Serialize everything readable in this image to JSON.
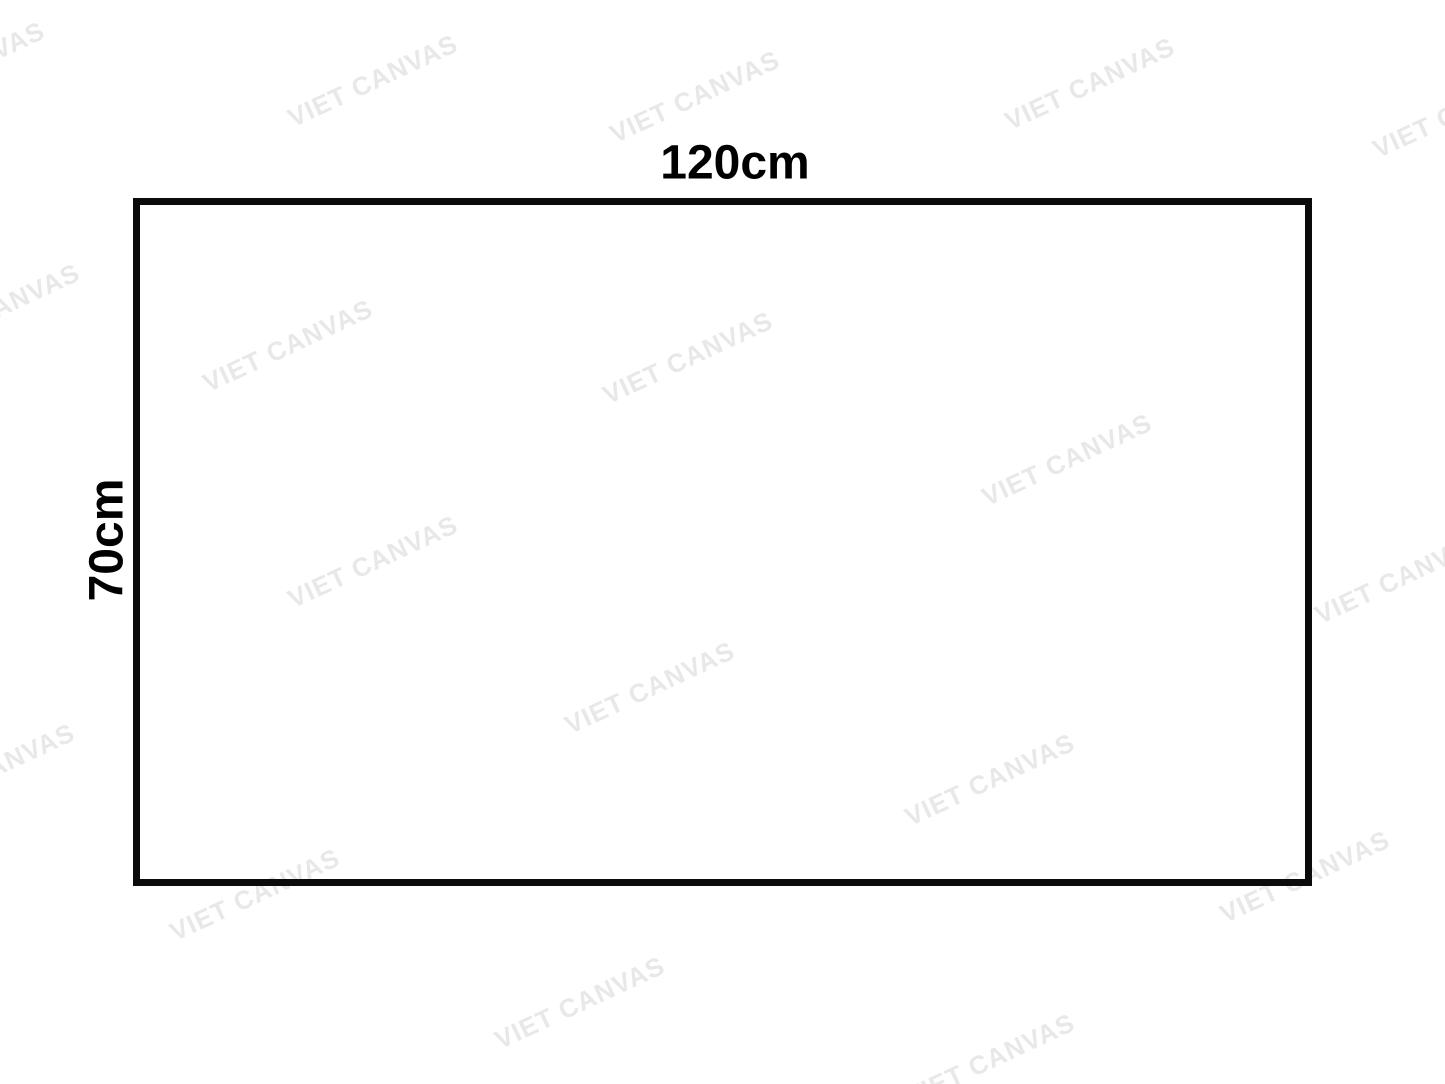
{
  "page": {
    "background_color": "#ffffff"
  },
  "watermark": {
    "text": "VIET CANVAS",
    "color": "#e8e8e8",
    "rotation_deg": -25,
    "positions": [
      {
        "x": -40,
        "y": 68
      },
      {
        "x": 373,
        "y": 81
      },
      {
        "x": 695,
        "y": 97
      },
      {
        "x": 1090,
        "y": 84
      },
      {
        "x": 1458,
        "y": 112
      },
      {
        "x": -5,
        "y": 310
      },
      {
        "x": 288,
        "y": 346
      },
      {
        "x": 688,
        "y": 358
      },
      {
        "x": 1067,
        "y": 460
      },
      {
        "x": 1400,
        "y": 578
      },
      {
        "x": 373,
        "y": 562
      },
      {
        "x": 650,
        "y": 688
      },
      {
        "x": 990,
        "y": 780
      },
      {
        "x": -10,
        "y": 770
      },
      {
        "x": 255,
        "y": 895
      },
      {
        "x": 1305,
        "y": 877
      },
      {
        "x": 580,
        "y": 1003
      },
      {
        "x": 990,
        "y": 1060
      }
    ]
  },
  "diagram": {
    "width_label": "120cm",
    "height_label": "70cm",
    "border_color": "#0b0b0b"
  }
}
